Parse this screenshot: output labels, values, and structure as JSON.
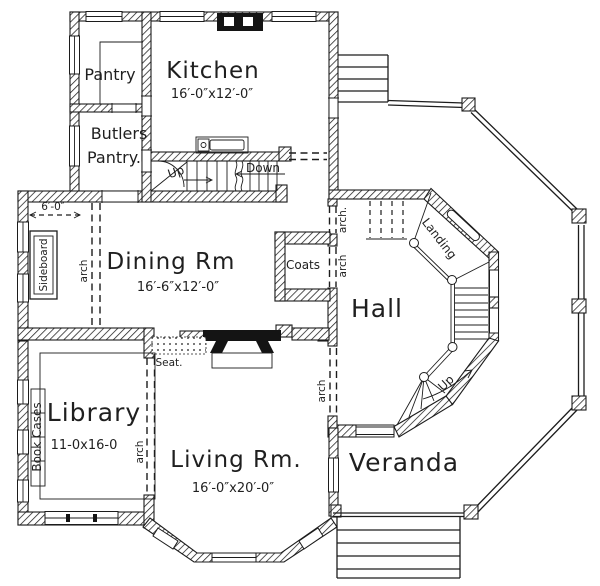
{
  "plan": {
    "rooms": {
      "kitchen": {
        "name": "Kitchen",
        "dims": "16′-0″x12′-0″"
      },
      "pantry": {
        "name": "Pantry"
      },
      "butlers_pantry": {
        "line1": "Butlers",
        "line2": "Pantry."
      },
      "dining": {
        "name": "Dining Rm",
        "dims": "16′-6″x12′-0″"
      },
      "coats": {
        "name": "Coats"
      },
      "hall": {
        "name": "Hall"
      },
      "library": {
        "name": "Library",
        "dims": "11-0x16-0"
      },
      "living": {
        "name": "Living Rm.",
        "dims": "16′-0″x20′-0″"
      },
      "veranda": {
        "name": "Veranda"
      }
    },
    "labels": {
      "up_main": "Up",
      "down_main": "Down",
      "up_tower": "Up",
      "landing": "Landing",
      "seat": "Seat.",
      "sideboard": "Sideboard",
      "bookcases": "Book Cases",
      "arch": "arch",
      "arch_dot": "arch.",
      "dim_6ft": "6′-0″"
    },
    "colors": {
      "ink": "#1c1c1c",
      "paper": "#ffffff"
    }
  }
}
